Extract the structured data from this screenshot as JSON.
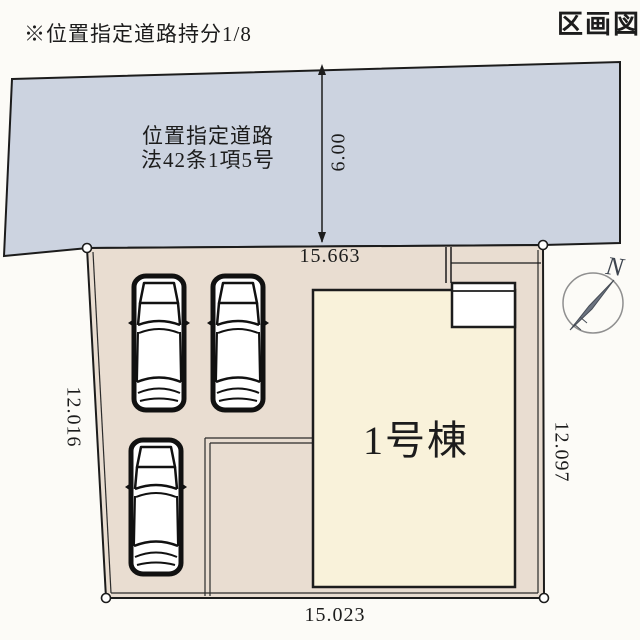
{
  "header": {
    "note": "※位置指定道路持分1/8",
    "doc_type": "区画図"
  },
  "road": {
    "name_line1": "位置指定道路",
    "name_line2": "法42条1項5号",
    "width": "6.00"
  },
  "plot": {
    "dim_top": "15.663",
    "dim_bottom": "15.023",
    "dim_left": "12.016",
    "dim_right": "12.097"
  },
  "building": {
    "label": "1号棟"
  },
  "compass": {
    "north_label": "N"
  },
  "colors": {
    "road": "#ccd3e0",
    "plot": "#e9ddd1",
    "building": "#f9f2da",
    "porch": "#ffffff",
    "line": "#1c1c1c"
  }
}
